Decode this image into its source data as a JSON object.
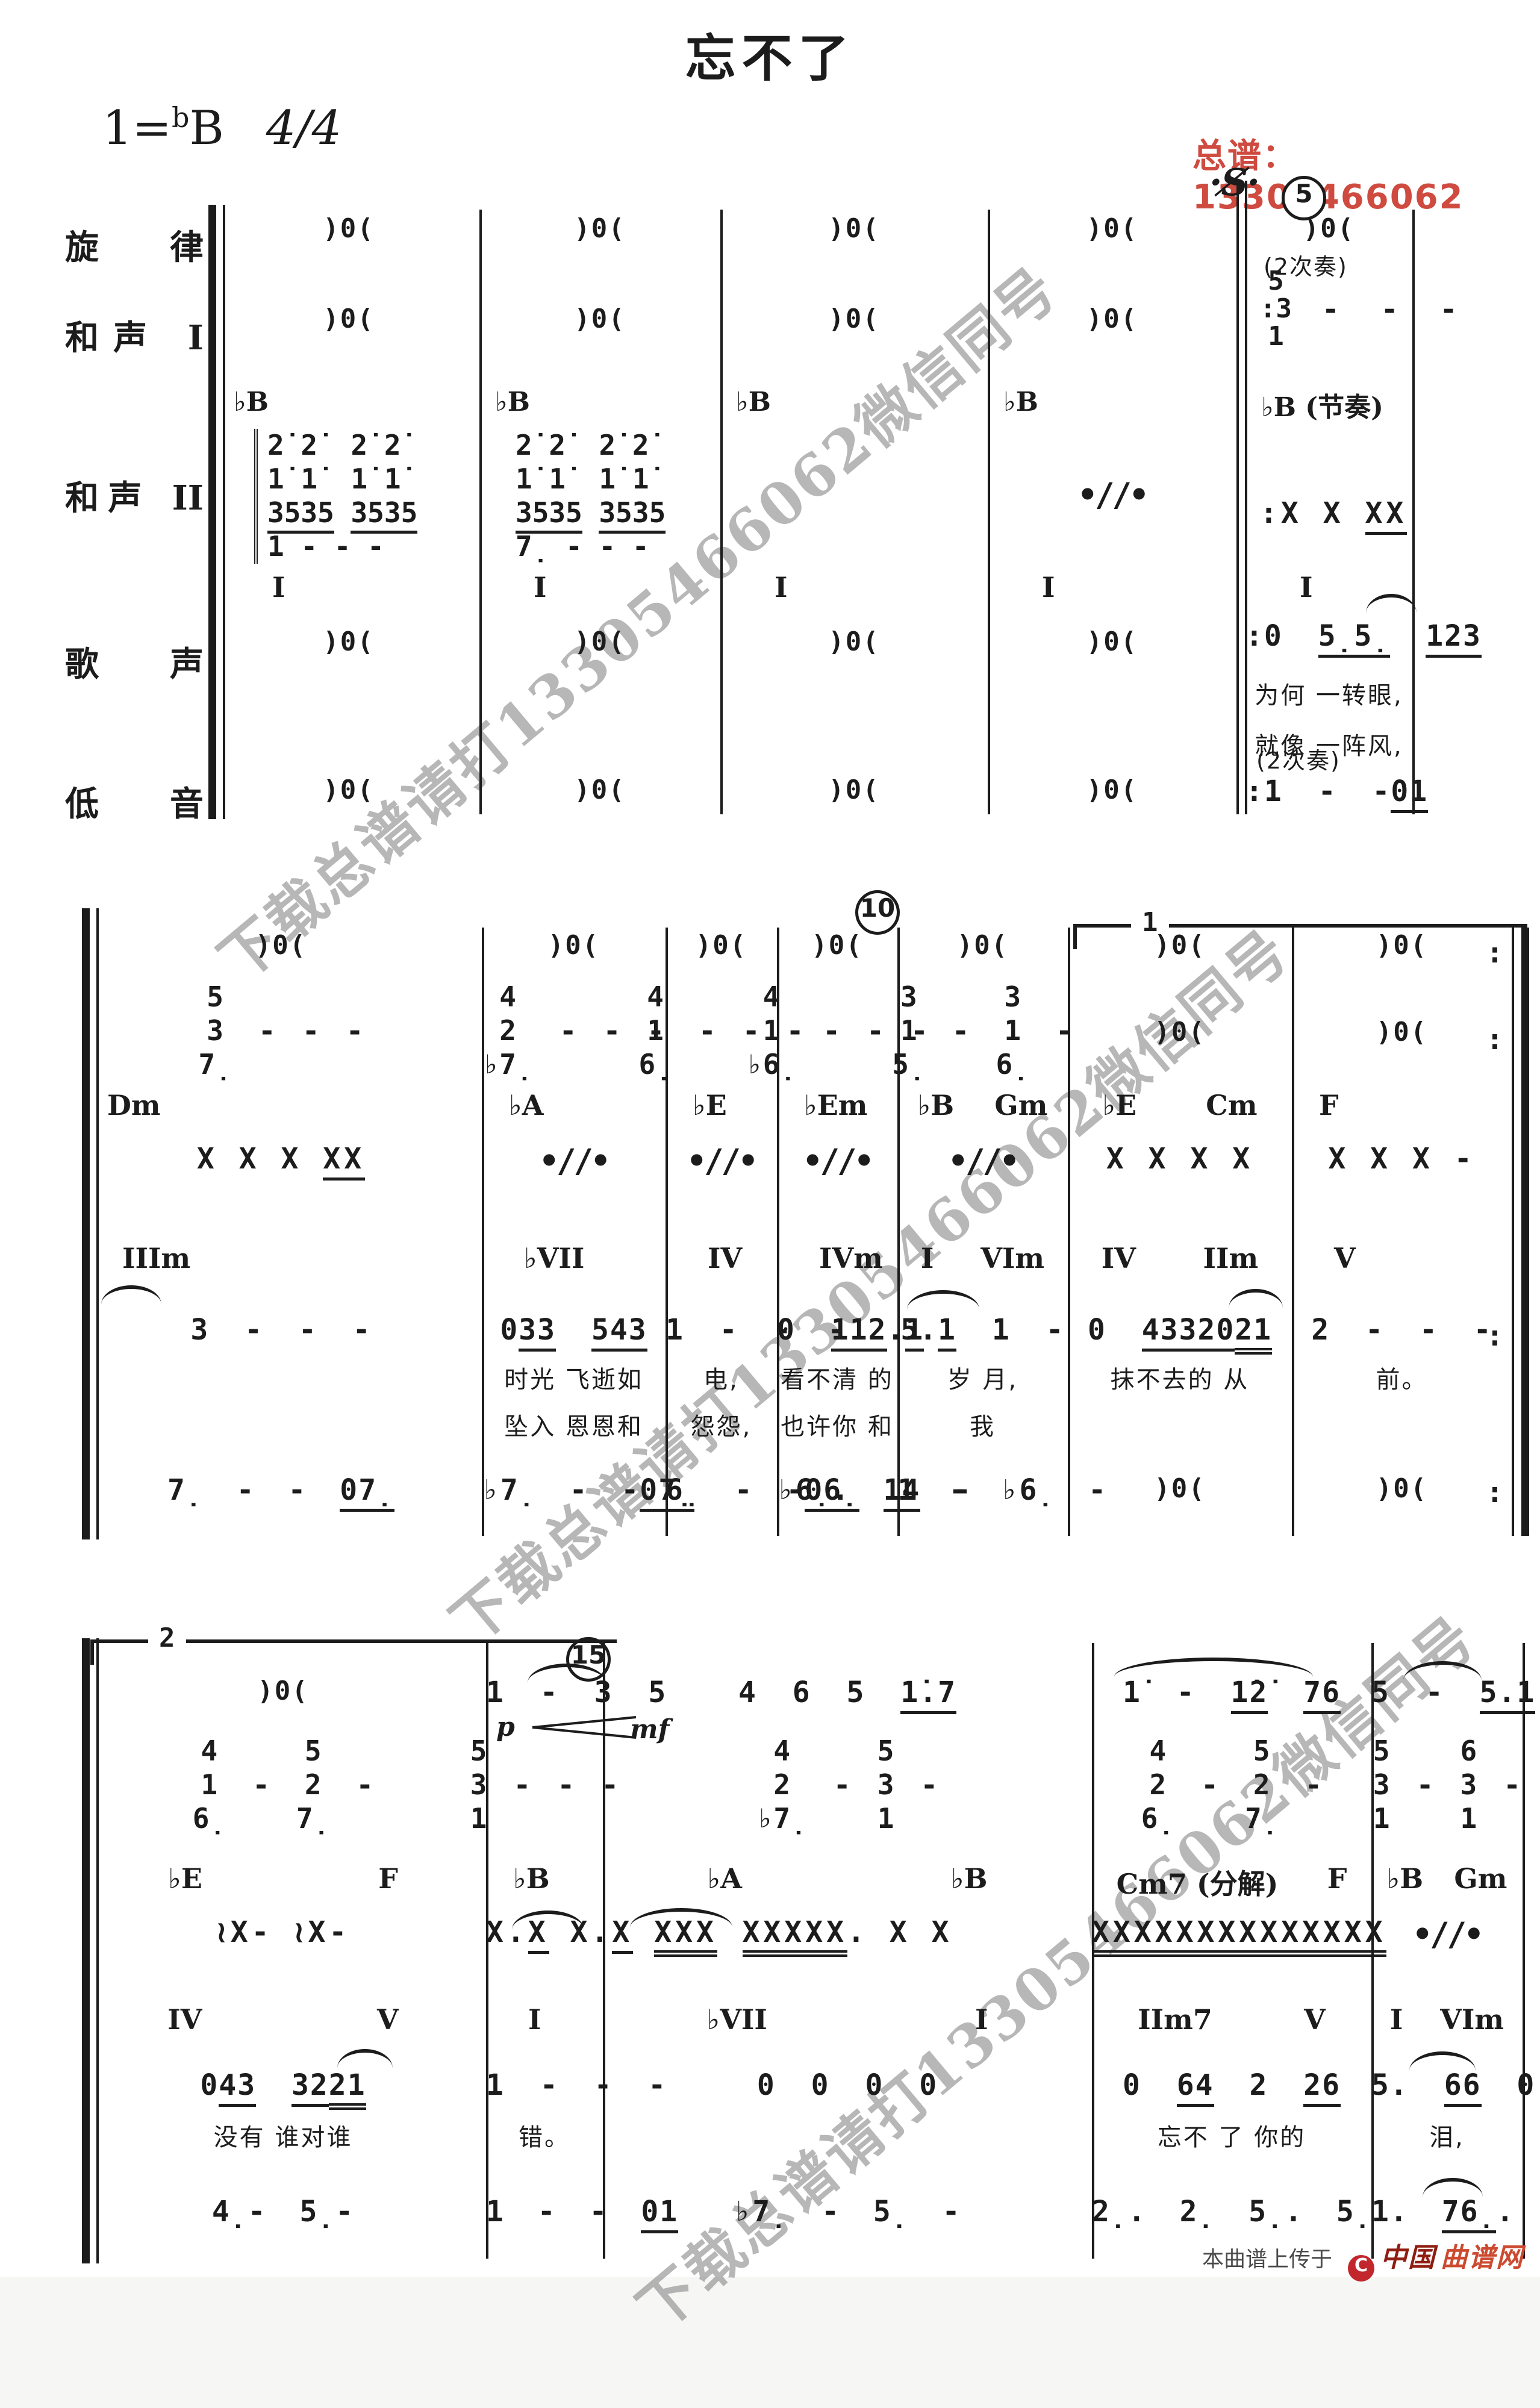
{
  "header": {
    "title": "忘不了",
    "key_prefix": "1=",
    "key_flat": "b",
    "key_note": "B",
    "meter": "4/4",
    "contact": "总谱：13305466062"
  },
  "watermark": {
    "text": "下载总谱请打13305466062微信同号"
  },
  "markers": {
    "segno": "·S̸·",
    "m5": "5",
    "m10": "10",
    "m15": "15",
    "volta1": "1",
    "volta2": "2"
  },
  "parts": {
    "labels": [
      "旋 律",
      "和声 I",
      "和声 II",
      "歌 声",
      "低 音"
    ]
  },
  "system1": {
    "measures": [
      {
        "melody_rest": ")0(",
        "harmony1_rest": ")0(",
        "harmony2_chord": "♭B",
        "harmony2_stack": [
          "2̇ 2̇  2̇ 2̇",
          "1̇ 1̇  1̇ 1̇",
          "[3535] [3535]",
          "1 - - -"
        ],
        "harmony2_roman": "I",
        "vocal_rest": ")0(",
        "bass_rest": ")0("
      },
      {
        "melody_rest": ")0(",
        "harmony1_rest": ")0(",
        "harmony2_chord": "♭B",
        "harmony2_stack": [
          "2̇ 2̇  2̇ 2̇",
          "1̇ 1̇  1̇ 1̇",
          "[3535] [3535]",
          "7̣ - - -"
        ],
        "harmony2_roman": "I",
        "vocal_rest": ")0(",
        "bass_rest": ")0("
      },
      {
        "melody_rest": ")0(",
        "harmony1_rest": ")0(",
        "harmony2_chord": "♭B",
        "harmony2_roman": "I",
        "vocal_rest": ")0(",
        "bass_rest": ")0("
      },
      {
        "melody_rest": ")0(",
        "harmony1_rest": ")0(",
        "harmony2_chord": "♭B",
        "harmony2_simile": "simile",
        "harmony2_roman": "I",
        "vocal_rest": ")0(",
        "bass_rest": ")0("
      },
      {
        "melody_rest": ")0(",
        "harmony1_note": "(2次奏)",
        "harmony1_stack": [
          "5",
          ":3",
          "1"
        ],
        "harmony1_dashes": "- - -",
        "harmony2_chord": "♭B (节奏)",
        "harmony2_rhythm": ":X X [XX]",
        "harmony2_roman": "I",
        "vocal_melody": ":0 [5̣5̣] [123]",
        "vocal_lyrics1": "为何 一转眼,",
        "vocal_lyrics2": "就像 一阵风,",
        "bass_note": "(2次奏)",
        "bass_melody": ":1 - -[01]"
      }
    ]
  },
  "system2": {
    "measures": [
      {
        "rest": ")0(",
        "stack": [
          [
            "5",
            "3",
            "7̣"
          ],
          "-",
          "-",
          "-"
        ],
        "chord": [
          "Dm"
        ],
        "rhythm": "X X X [XX]",
        "roman": [
          "IIIm"
        ],
        "melody": "3 - - -",
        "bass": "7̣ - - [07̣]"
      },
      {
        "rest": ")0(",
        "stack": [
          [
            "4",
            "2",
            "♭7̣"
          ],
          "-",
          "-",
          "-"
        ],
        "chord": [
          "♭A"
        ],
        "rhythm": "simile",
        "roman": [
          "♭VII"
        ],
        "melody": "0[33] [54][3]",
        "lyrics1": "时光 飞逝如",
        "lyrics2": "坠入 恩恩和",
        "bass": "♭7̣ - -[07̣]"
      },
      {
        "rest": ")0(",
        "stack": [
          [
            "4",
            "1",
            "6̣"
          ],
          "-",
          "-",
          "-"
        ],
        "chord": [
          "♭E"
        ],
        "rhythm": "simile",
        "roman": [
          "IV"
        ],
        "melody": "1 - - -",
        "lyrics1": "电,",
        "lyrics2": "怨怨,",
        "bass": "6̣ - -[06̣]"
      },
      {
        "rest": ")0(",
        "stack": [
          [
            "4",
            "1",
            "♭6̣"
          ],
          "-",
          "-",
          "-"
        ],
        "chord": [
          "♭Em"
        ],
        "rhythm": "simile",
        "roman": [
          "IVm"
        ],
        "melody": "0 [112].[1]",
        "lyrics1": "看不清 的",
        "lyrics2": "也许你 和",
        "bass": "♭6̣. [14] -"
      },
      {
        "rest": ")0(",
        "stack": [
          [
            "3",
            "1",
            "5̣"
          ],
          "-",
          [
            "3",
            "1",
            "6̣"
          ],
          "-"
        ],
        "chord": [
          "♭B",
          "Gm"
        ],
        "rhythm": "simile",
        "roman": [
          "I",
          "VIm"
        ],
        "melody": "5.[1] 1 -",
        "lyrics1": "岁 月,",
        "lyrics2": "我",
        "bass": "1 - ♭6̣ -"
      },
      {
        "rest": ")0(",
        "stack": ")0(",
        "chord": [
          "♭E",
          "Cm"
        ],
        "rhythm": "X X X X",
        "roman": [
          "IV",
          "IIm"
        ],
        "melody": "0 [433][20]{21}",
        "lyrics1": "抹不去的 从",
        "bass": ")0("
      },
      {
        "rest": ")0(",
        "stack": ")0(",
        "chord": [
          "F"
        ],
        "rhythm": "X X X -",
        "roman": [
          "V"
        ],
        "melody": "2 - - -",
        "lyrics1": "前。",
        "bass": ")0("
      }
    ]
  },
  "system3": {
    "measures": [
      {
        "top": ")0(",
        "stack": [
          [
            "4",
            "1",
            "6̣"
          ],
          "-",
          [
            "5",
            "2",
            "7̣"
          ],
          "-"
        ],
        "chord": [
          "♭E",
          "F"
        ],
        "rhythm": "≀X- ≀X-",
        "roman": [
          "IV",
          "V"
        ],
        "vocal": "0[43] [32]{21}",
        "lyrics": "没有 谁对谁",
        "bass": "4̣- 5̣-"
      },
      {
        "top": "1 - 3 5",
        "dyn": "p",
        "stack": [
          [
            "5",
            "3",
            "1"
          ],
          "-",
          "-",
          "-"
        ],
        "chord": [
          "♭B"
        ],
        "rhythm": "X.[X] X.[X] {XXX}",
        "roman": [
          "I"
        ],
        "vocal": "1 - - -",
        "lyrics": "错。",
        "bass": "1 - - [01]"
      },
      {
        "top": "4 6 5 [1̇.7]",
        "dyn": "mf",
        "stack": [
          [
            "4",
            "2",
            "♭7̣"
          ],
          "-",
          [
            "5",
            "3",
            "1"
          ],
          "-"
        ],
        "chord": [
          "♭A",
          "♭B"
        ],
        "rhythm": "{XXXXX}. X X",
        "roman": [
          "♭VII",
          "I"
        ],
        "vocal": "0 0 0 0",
        "bass": "♭7̣ - 5̣ -"
      },
      {
        "top": "1̇ - [1̇2̇] [76]",
        "stack": [
          [
            "4",
            "2",
            "6̣"
          ],
          "-",
          [
            "5",
            "2",
            "7̣"
          ],
          "-"
        ],
        "chord": [
          "Cm7 (分解)",
          "F"
        ],
        "rhythm": "{XXXXXXX}{XXXXXXX}",
        "roman": [
          "IIm7",
          "V"
        ],
        "vocal": "0 [64] 2 [26]",
        "lyrics": "忘不 了 你的",
        "bass": "2̣. 2̣ 5̣. 5̣"
      },
      {
        "top": "5 - [5.1̇] [17]",
        "stack": [
          [
            "5",
            "3",
            "1"
          ],
          "-",
          [
            "6",
            "3",
            "1"
          ],
          "-"
        ],
        "chord": [
          "♭B",
          "Gm"
        ],
        "rhythm": "simile",
        "roman": [
          "I",
          "VIm"
        ],
        "vocal": "5. [66] 0",
        "lyrics": "泪,",
        "bass": "1. [76̣]. 3"
      }
    ]
  },
  "footer": {
    "prefix": "本曲谱上传于",
    "logo": "C",
    "brand1": "中国",
    "brand2": "曲谱网"
  }
}
